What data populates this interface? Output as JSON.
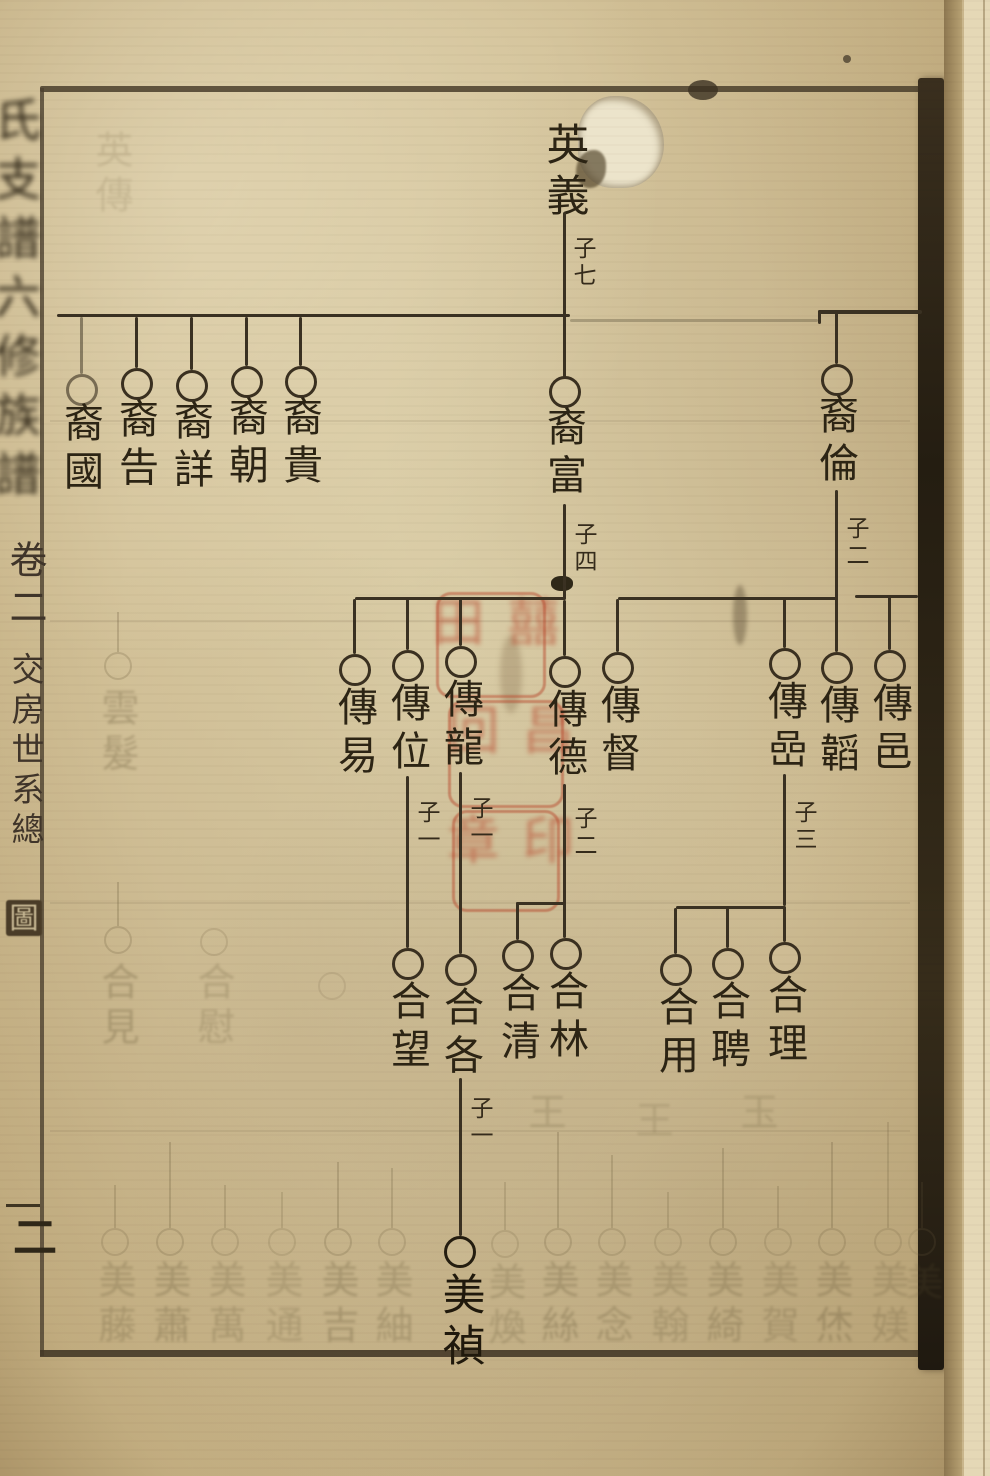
{
  "document": {
    "kind": "Chinese clan genealogy chart (scanned woodblock print page)",
    "spine_title_illegible": "氏支譜六修族譜",
    "volume": "卷二",
    "section_title_main": "交房世系總",
    "section_title_last": "圖",
    "page_number": "二"
  },
  "tree": {
    "root": {
      "name": "英義",
      "sons_label": "子七"
    },
    "gen1": [
      {
        "name": "裔國"
      },
      {
        "name": "裔告"
      },
      {
        "name": "裔詳"
      },
      {
        "name": "裔朝"
      },
      {
        "name": "裔貴"
      },
      {
        "name": "裔富",
        "sons_label": "子四"
      },
      {
        "name": "裔倫",
        "sons_label": "子二"
      }
    ],
    "gen2": [
      {
        "name": "傳易"
      },
      {
        "name": "傳位",
        "sons_label": "子一"
      },
      {
        "name": "傳龍",
        "sons_label": "子一"
      },
      {
        "name": "傳德",
        "sons_label": "子二"
      },
      {
        "name": "傳督"
      },
      {
        "name": "傳嵒",
        "sons_label": "子三"
      },
      {
        "name": "傳韜"
      },
      {
        "name": "傳邑"
      }
    ],
    "gen3": [
      {
        "name": "合望"
      },
      {
        "name": "合各",
        "sons_label": "子一"
      },
      {
        "name": "合清"
      },
      {
        "name": "合林"
      },
      {
        "name": "合用"
      },
      {
        "name": "合聘"
      },
      {
        "name": "合理"
      }
    ],
    "gen4": [
      {
        "name": "美禎"
      }
    ]
  },
  "seal": {
    "color": "#b84a2c",
    "illegible_marks": [
      "囍田",
      "昌回",
      "印章"
    ]
  },
  "ghosts": {
    "bottom_row": [
      {
        "x": 115,
        "line_top": 1185,
        "circle_top": 1228,
        "name_top": 1260,
        "name": "美藤",
        "opacity": 0.45
      },
      {
        "x": 170,
        "line_top": 1142,
        "circle_top": 1228,
        "name_top": 1260,
        "name": "美蕭",
        "opacity": 0.5
      },
      {
        "x": 225,
        "line_top": 1185,
        "circle_top": 1228,
        "name_top": 1260,
        "name": "美萬",
        "opacity": 0.42
      },
      {
        "x": 282,
        "line_top": 1192,
        "circle_top": 1228,
        "name_top": 1260,
        "name": "美通",
        "opacity": 0.38
      },
      {
        "x": 338,
        "line_top": 1162,
        "circle_top": 1228,
        "name_top": 1260,
        "name": "美吉",
        "opacity": 0.5
      },
      {
        "x": 392,
        "line_top": 1168,
        "circle_top": 1228,
        "name_top": 1260,
        "name": "美紬",
        "opacity": 0.45
      },
      {
        "x": 505,
        "line_top": 1182,
        "circle_top": 1230,
        "name_top": 1262,
        "name": "美煥",
        "opacity": 0.4
      },
      {
        "x": 558,
        "line_top": 1132,
        "circle_top": 1228,
        "name_top": 1260,
        "name": "美絲",
        "opacity": 0.5
      },
      {
        "x": 612,
        "line_top": 1155,
        "circle_top": 1228,
        "name_top": 1260,
        "name": "美念",
        "opacity": 0.45
      },
      {
        "x": 668,
        "line_top": 1192,
        "circle_top": 1228,
        "name_top": 1260,
        "name": "美翰",
        "opacity": 0.4
      },
      {
        "x": 723,
        "line_top": 1148,
        "circle_top": 1228,
        "name_top": 1260,
        "name": "美綺",
        "opacity": 0.48
      },
      {
        "x": 778,
        "line_top": 1186,
        "circle_top": 1228,
        "name_top": 1260,
        "name": "美賀",
        "opacity": 0.42
      },
      {
        "x": 832,
        "line_top": 1142,
        "circle_top": 1228,
        "name_top": 1260,
        "name": "美烋",
        "opacity": 0.5
      },
      {
        "x": 888,
        "line_top": 1122,
        "circle_top": 1228,
        "name_top": 1260,
        "name": "美媄",
        "opacity": 0.4
      }
    ],
    "scattered": [
      {
        "x": 112,
        "name": "英傳",
        "name_top": 130,
        "opacity": 0.25
      },
      {
        "x": 118,
        "name": "雲髮",
        "name_top": 688,
        "circle_top": 652,
        "line_top": 612,
        "opacity": 0.5
      },
      {
        "x": 118,
        "name": "合見",
        "name_top": 962,
        "circle_top": 926,
        "line_top": 882,
        "opacity": 0.5
      },
      {
        "x": 214,
        "name": "合慰",
        "name_top": 962,
        "circle_top": 928,
        "opacity": 0.38
      },
      {
        "x": 332,
        "name": "",
        "circle_top": 972,
        "opacity": 0.3
      },
      {
        "x": 545,
        "name": "王",
        "name_top": 1092,
        "opacity": 0.35
      },
      {
        "x": 652,
        "name": "王",
        "name_top": 1100,
        "opacity": 0.3
      },
      {
        "x": 757,
        "name": "玉",
        "name_top": 1092,
        "opacity": 0.33
      },
      {
        "x": 922,
        "name": "美",
        "name_top": 1262,
        "circle_top": 1228,
        "line_top": 1182,
        "opacity": 0.3
      }
    ]
  }
}
